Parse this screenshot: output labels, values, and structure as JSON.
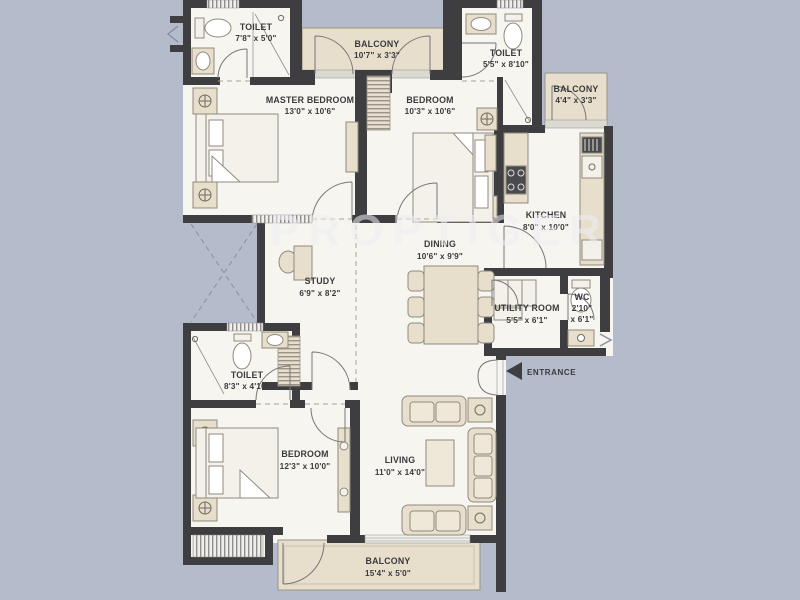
{
  "colors": {
    "background": "#b4bbca",
    "wall": "#3e3e40",
    "floor": "#f7f5f0",
    "beige": "#e7decb",
    "text": "#3a3a3c"
  },
  "watermark": "PROPTIGER",
  "entrance": {
    "label": "ENTRANCE"
  },
  "rooms": {
    "toilet_tl": {
      "name": "TOILET",
      "dims": "7'8\" x 5'0\""
    },
    "balcony_top": {
      "name": "BALCONY",
      "dims": "10'7\" x 3'3\""
    },
    "toilet_tr": {
      "name": "TOILET",
      "dims": "5'5\" x 8'10\""
    },
    "balcony_right": {
      "name": "BALCONY",
      "dims": "4'4\" x 3'3\""
    },
    "master_bedroom": {
      "name": "MASTER BEDROOM",
      "dims": "13'0\" x 10'6\""
    },
    "bedroom_top": {
      "name": "BEDROOM",
      "dims": "10'3\" x 10'6\""
    },
    "kitchen": {
      "name": "KITCHEN",
      "dims": "8'0\" x 10'0\""
    },
    "dining": {
      "name": "DINING",
      "dims": "10'6\" x 9'9\""
    },
    "study": {
      "name": "STUDY",
      "dims": "6'9\" x 8'2\""
    },
    "utility": {
      "name": "UTILITY ROOM",
      "dims": "5'5\" x 6'1\""
    },
    "wc": {
      "name": "WC",
      "dims": "2'10\"",
      "dims2": "x 6'1\""
    },
    "toilet_b": {
      "name": "TOILET",
      "dims": "8'3\" x 4'10\""
    },
    "bedroom_b": {
      "name": "BEDROOM",
      "dims": "12'3\" x 10'0\""
    },
    "living": {
      "name": "LIVING",
      "dims": "11'0\" x 14'0\""
    },
    "balcony_b": {
      "name": "BALCONY",
      "dims": "15'4\" x 5'0\""
    }
  }
}
